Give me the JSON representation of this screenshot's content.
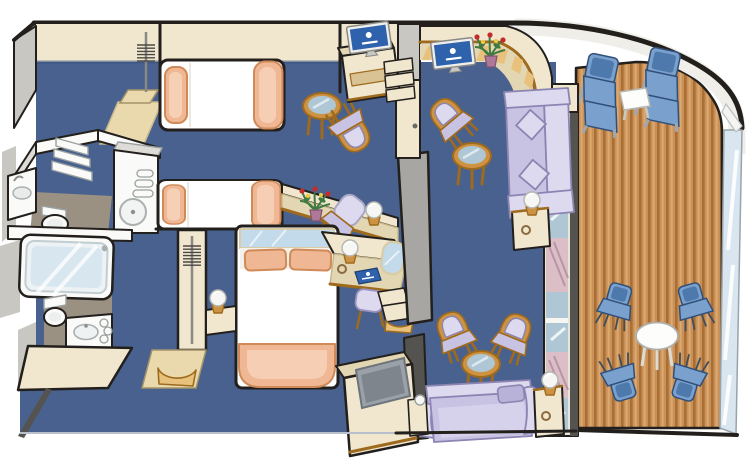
{
  "page": {
    "title": "Cruise ship two-bedroom family suite floor plan with balcony (isometric cutaway illustration)",
    "background": "#FFFFFF"
  },
  "palette": {
    "outline": "#221F1C",
    "carpet": "#48618F",
    "carpet_shadow": "#3A5280",
    "wall_cream": "#F0E7CE",
    "wall_cream_dark": "#E3D6B2",
    "floor_beige": "#EBD9AE",
    "wood": "#CE9342",
    "wood_dark": "#9E6A1E",
    "wood_light": "#E8C27D",
    "gray_wall": "#C9C7C2",
    "gray_light": "#DEDCD7",
    "gray_slab": "#A8A6A2",
    "dark_slab": "#55534F",
    "white_fixture": "#FAFAF8",
    "taupe_floor": "#9B9183",
    "tub_blue": "#D7E6EF",
    "bed_white": "#FFFFFF",
    "peach": "#EFB793",
    "peach_dark": "#D08A58",
    "peach_light": "#F8D6BE",
    "lavender": "#C9C3E3",
    "lavender_light": "#DDD9EF",
    "lavender_dark": "#8C84B2",
    "chair_blue": "#7AA0CD",
    "chair_blue_dark": "#4E79AC",
    "deck_wood": "#C99159",
    "deck_wood_dark": "#A96F33",
    "deck_wood_light": "#DCA96E",
    "hull_white": "#EFEEE8",
    "hull_gray": "#D5D3CC",
    "railing_glass": "#D9E6EF",
    "glass": "#AFC6D4",
    "glass_light": "#DCE9F0",
    "mirror_blue": "#C2DAEA",
    "curtain_pink": "#DCBEC6",
    "curtain_fold": "#B895A5",
    "tv_blue": "#2E62AC",
    "tv_frame": "#EFEFED",
    "tv_gray": "#9AA1A8",
    "lamp_white": "#F6F6F4",
    "flower_green": "#3F7A40",
    "flower_red": "#C42B2B",
    "flower_yellow": "#E9C93E",
    "flower_pot": "#B07898"
  },
  "rooms": [
    {
      "id": "bedroom-upper",
      "label": "Bedroom with twin bed",
      "furniture": [
        "twin bed with peach pillow and throw",
        "wardrobe with coat hangers",
        "round glass table",
        "armchair with lavender cushion"
      ]
    },
    {
      "id": "bedroom-lower",
      "label": "Second bedroom with twin bed",
      "furniture": [
        "twin bed with peach pillow and throw",
        "desk with flower bouquet",
        "desk chair",
        "globe table lamp"
      ]
    },
    {
      "id": "bathroom-shower",
      "label": "Shower bathroom",
      "furniture": [
        "washbasin counter",
        "toilet",
        "shelf unit",
        "vanity cabinet with round basin",
        "towels"
      ]
    },
    {
      "id": "bathroom-tub",
      "label": "Bathroom with bathtub",
      "furniture": [
        "bathtub with glass shower screen",
        "toilet",
        "washbasin cabinet",
        "rolled towels"
      ]
    },
    {
      "id": "master-bedroom",
      "label": "Master bedroom",
      "furniture": [
        "double bed with two peach pillows",
        "mirrored headboard panel",
        "bedside cabinet with globe lamp",
        "vanity counter with globe lamp",
        "blue logo folder",
        "arched mirror",
        "stool with lavender cushion",
        "wardrobe with coat hangers",
        "entry steps"
      ]
    },
    {
      "id": "living-room",
      "label": "Living room",
      "furniture": [
        "curved corner desk with flat-screen TV and flower bouquet",
        "TV cabinet with flat-screen TV",
        "armchair with lavender cushion",
        "round glass cocktail table",
        "lavender sofa with two diamond cushions",
        "side table with globe lamp",
        "two armchairs with round glass table",
        "second lavender sofa",
        "side tables with globe lamps",
        "TV cabinet with gray flat-screen TV"
      ]
    },
    {
      "id": "balcony",
      "label": "Private teak balcony",
      "furniture": [
        "two blue sun loungers",
        "white square table",
        "four blue chairs",
        "white round table",
        "glass railing"
      ]
    }
  ],
  "fixtures": {
    "tv_count": 3,
    "tv_screens": [
      "blue with white cruise-line crest",
      "blue with white cruise-line crest",
      "gray blank"
    ],
    "flower_bouquets": 2,
    "globe_lamps": 6
  }
}
